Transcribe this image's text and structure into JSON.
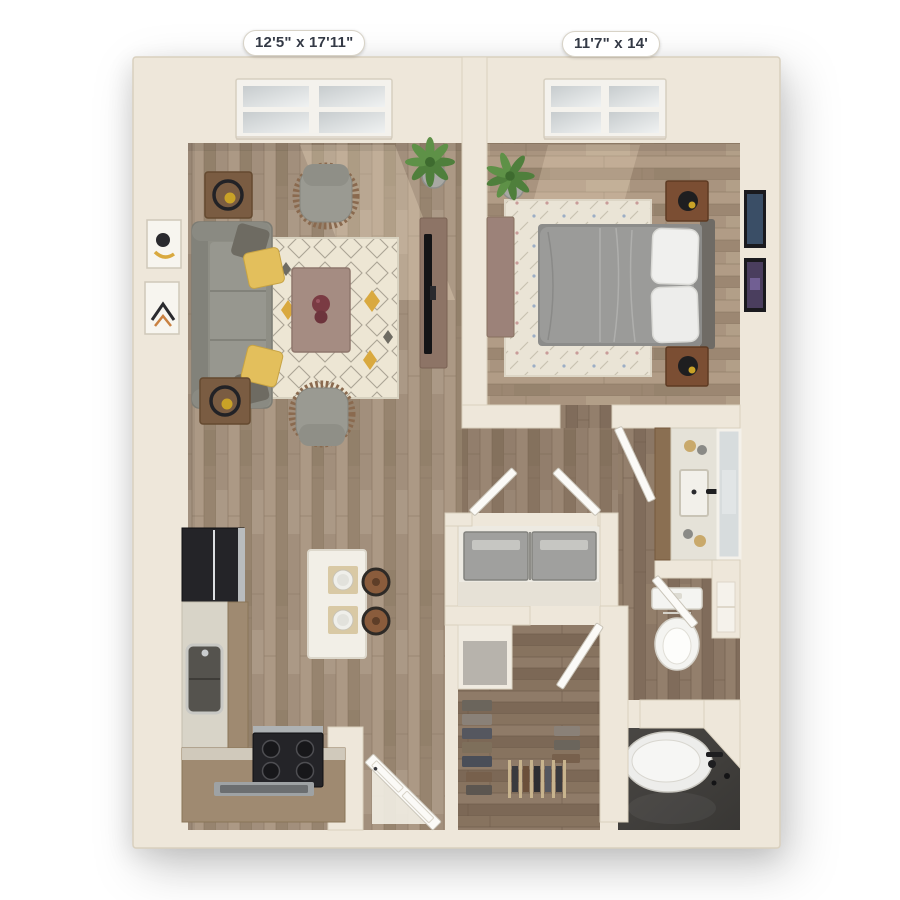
{
  "labels": {
    "living_room": "12'5\" x 17'11\"",
    "bedroom": "11'7\" x 14'"
  },
  "colors": {
    "background": "#FFFFFF",
    "wall": "#EEE7DA",
    "wall_edge": "#D9D0BE",
    "floor_main": "#A3907E",
    "floor_bedroom": "#A9947F",
    "floor_dark": "#8B7765",
    "bath_tile": "#413F3C",
    "rug_living": "#EDE6D4",
    "rug_bedroom": "#EAE4D6",
    "rug_accent_yellow": "#D9A93F",
    "sofa_gray": "#8E8E85",
    "pillow_yellow": "#E3BF5C",
    "pillow_gray": "#6E6B62",
    "coffee_table": "#A58C82",
    "tv_console": "#8D7466",
    "island_white": "#F2EFE7",
    "counter_light": "#D8D4C8",
    "cabinet_wood": "#9F8A71",
    "appliance_black": "#242428",
    "washer_gray": "#A0A09E",
    "fixture_white": "#F2F1EE",
    "mirror_glass": "#D7DCDD",
    "stool_brown": "#8A5C3C",
    "nightstand_wood": "#7B4E33",
    "plant_green": "#4F7F3C",
    "door_white": "#FBFAF7",
    "label_text": "#343A46"
  }
}
